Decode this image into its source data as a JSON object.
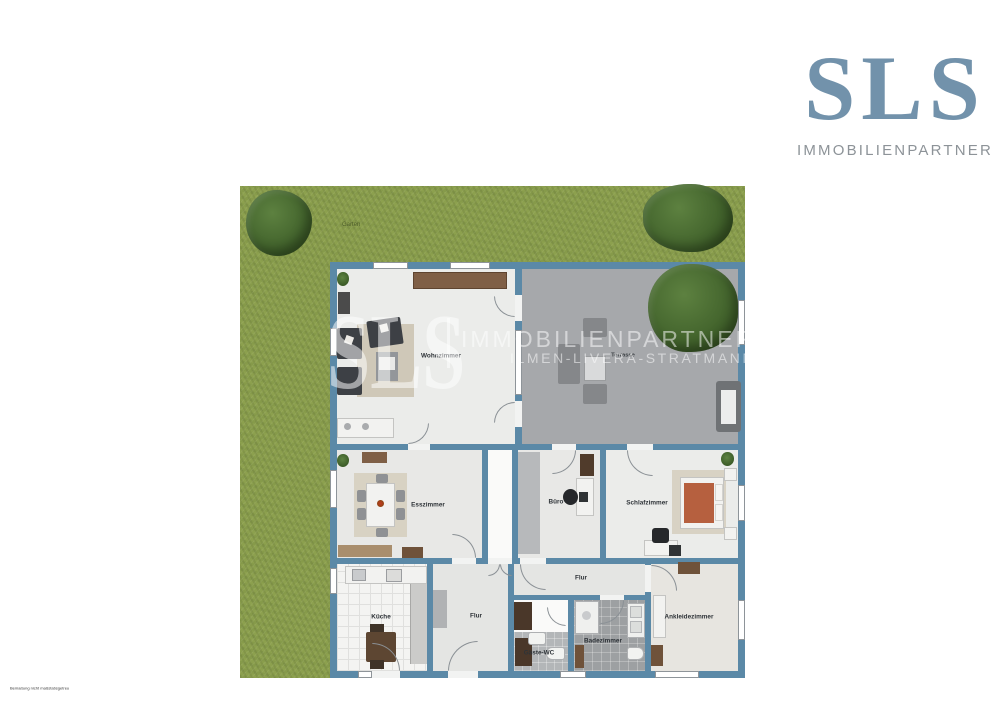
{
  "brand": {
    "name": "SLS",
    "subtitle": "IMMOBILIENPARTNER",
    "name_color": "#7292ab",
    "subtitle_color": "#8d9398"
  },
  "watermark": {
    "name": "SLS",
    "line1": "IMMOBILIENPARTNER",
    "line2": "ILMEN-LIVERA-STRATMANN"
  },
  "site": {
    "garden_label": "Garten"
  },
  "rooms": {
    "wohnzimmer": "Wohnzimmer",
    "terrasse": "Terrasse",
    "esszimmer": "Esszimmer",
    "buero": "Büro",
    "schlafzimmer": "Schlafzimmer",
    "kueche": "Küche",
    "flur": "Flur",
    "flur_sued": "Flur",
    "gaeste_wc": "Gäste-WC",
    "badezimmer": "Badezimmer",
    "ankleidezimmer": "Ankleidezimmer"
  },
  "footer": {
    "disclaimer": "Bemaßung nicht maßstabsgetreu"
  },
  "colors": {
    "wall": "#5b89a7",
    "grass": "#8ca04e",
    "terrace": "#a6a8ab",
    "floor": "#ebecea",
    "bed_accent": "#b6603f",
    "logo_blue": "#7292ab",
    "watermark_white": "rgba(255,255,255,0.52)"
  }
}
